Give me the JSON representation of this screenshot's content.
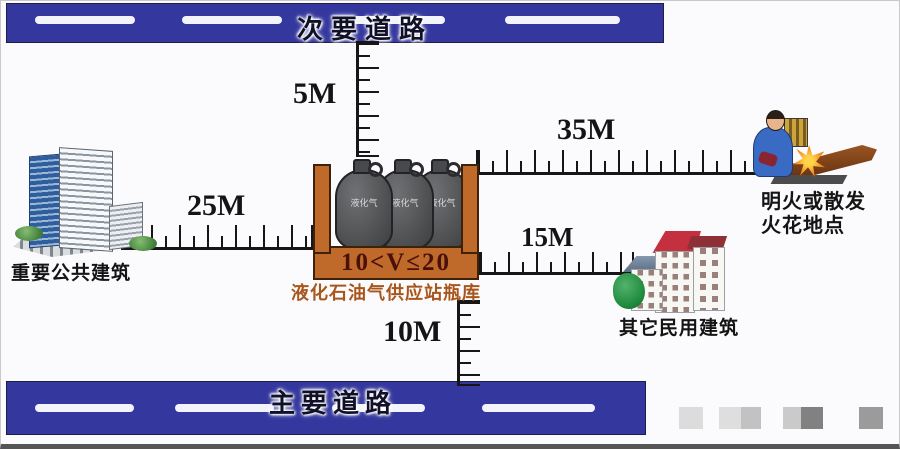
{
  "colors": {
    "road_blue": "#34379e",
    "container_orange": "#bf6a2a",
    "container_border": "#3e2208",
    "volume_text": "#4a100a",
    "station_name_text": "#a8561c"
  },
  "roads": {
    "secondary": "次要道路",
    "main": "主要道路"
  },
  "distances": {
    "to_secondary_road": "5M",
    "to_public_building": "25M",
    "to_fire_spot": "35M",
    "to_civil_building": "15M",
    "to_main_road": "10M"
  },
  "station": {
    "volume_label": "10<V≤20",
    "name": "液化石油气供应站瓶库",
    "cylinder_label": "液化气"
  },
  "buildings": {
    "public": "重要公共建筑",
    "civil": "其它民用建筑"
  },
  "fire_spot": {
    "line1": "明火或散发",
    "line2": "火花地点"
  }
}
